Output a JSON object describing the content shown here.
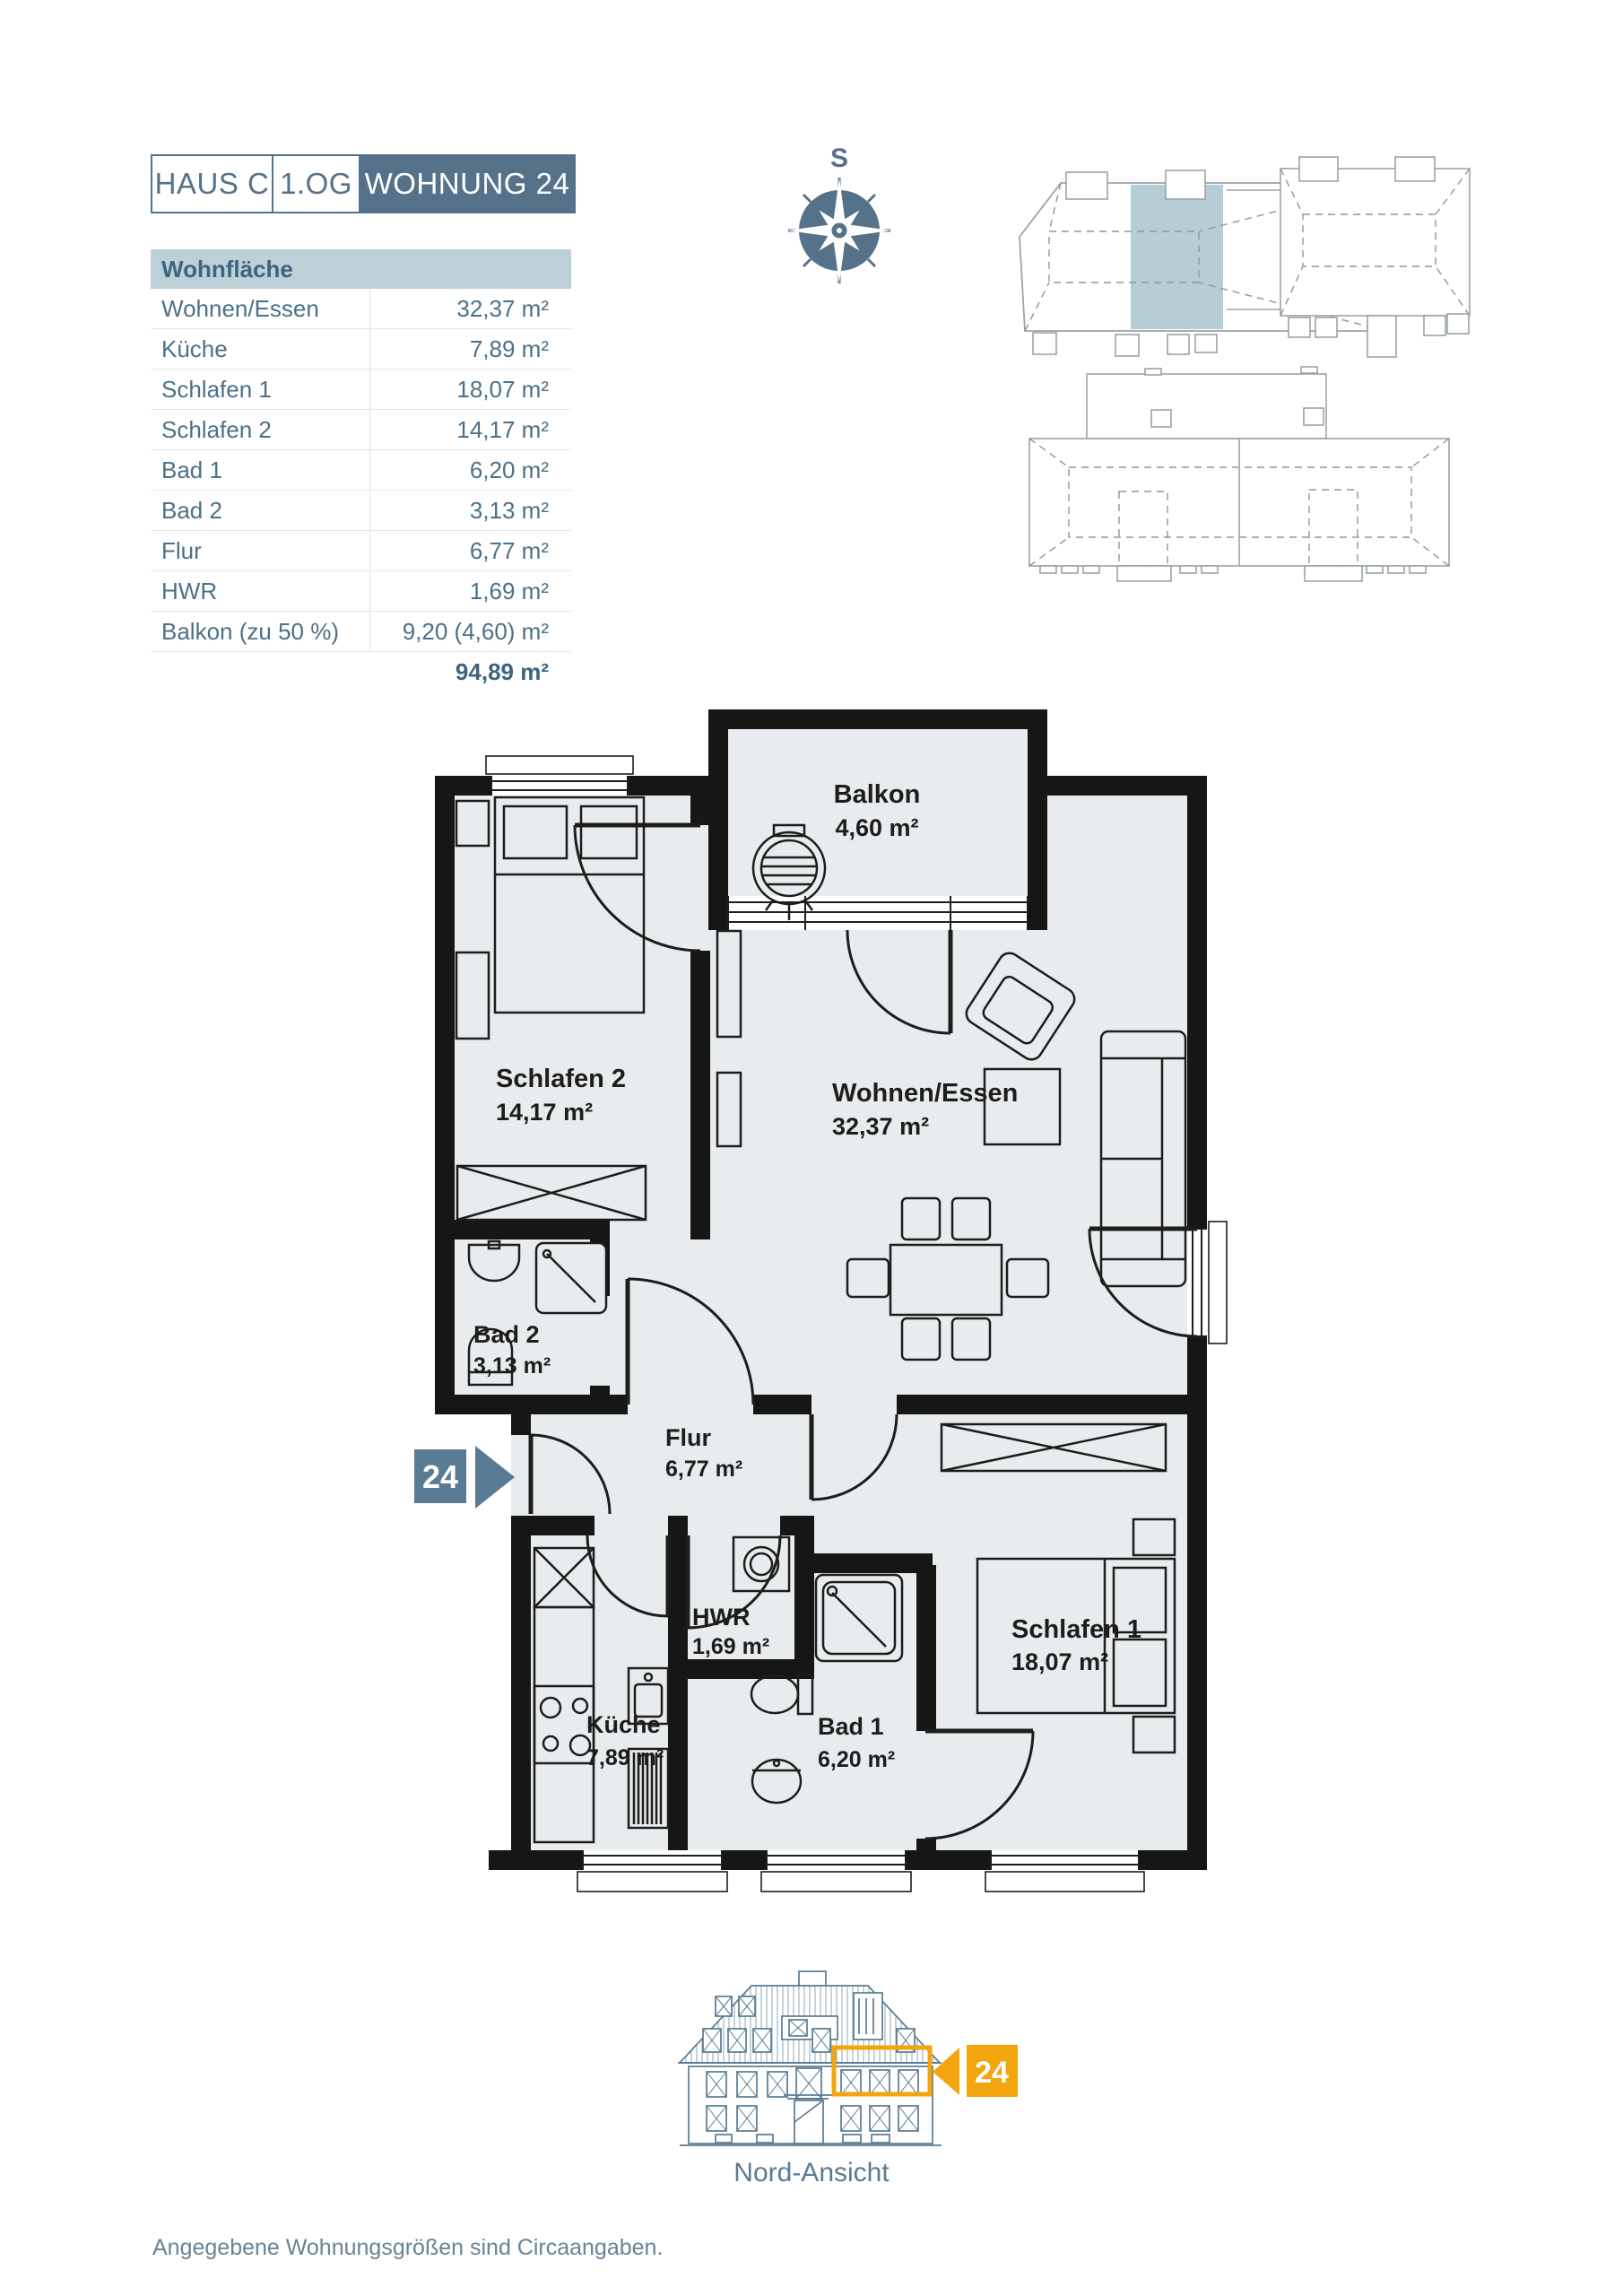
{
  "header": {
    "house": "HAUS C",
    "floor": "1.OG",
    "unit": "WOHNUNG 24"
  },
  "area_table": {
    "title": "Wohnfläche",
    "rows": [
      {
        "label": "Wohnen/Essen",
        "value": "32,37 m²"
      },
      {
        "label": "Küche",
        "value": "7,89 m²"
      },
      {
        "label": "Schlafen 1",
        "value": "18,07 m²"
      },
      {
        "label": "Schlafen 2",
        "value": "14,17 m²"
      },
      {
        "label": "Bad 1",
        "value": "6,20 m²"
      },
      {
        "label": "Bad 2",
        "value": "3,13 m²"
      },
      {
        "label": "Flur",
        "value": "6,77 m²"
      },
      {
        "label": "HWR",
        "value": "1,69 m²"
      },
      {
        "label": "Balkon (zu 50 %)",
        "value": "9,20 (4,60) m²"
      }
    ],
    "total": "94,89 m²"
  },
  "compass": {
    "south_label": "S"
  },
  "floor_plan": {
    "entry_badge": "24",
    "rooms": {
      "balkon": {
        "name": "Balkon",
        "area": "4,60 m²"
      },
      "schlafen2": {
        "name": "Schlafen 2",
        "area": "14,17 m²"
      },
      "wohnen_essen": {
        "name": "Wohnen/Essen",
        "area": "32,37 m²"
      },
      "bad2": {
        "name": "Bad 2",
        "area": "3,13 m²"
      },
      "flur": {
        "name": "Flur",
        "area": "6,77 m²"
      },
      "hwr": {
        "name": "HWR",
        "area": "1,69 m²"
      },
      "kueche": {
        "name": "Küche",
        "area": "7,89 m²"
      },
      "bad1": {
        "name": "Bad 1",
        "area": "6,20 m²"
      },
      "schlafen1": {
        "name": "Schlafen 1",
        "area": "18,07 m²"
      }
    }
  },
  "elevation": {
    "caption": "Nord-Ansicht",
    "badge": "24"
  },
  "footer": {
    "note": "Angegebene Wohnungsgrößen sind Circaangaben."
  },
  "colors": {
    "accent": "#56718a",
    "site_highlight": "#b5cdd4",
    "marker_orange": "#f2a50c"
  }
}
